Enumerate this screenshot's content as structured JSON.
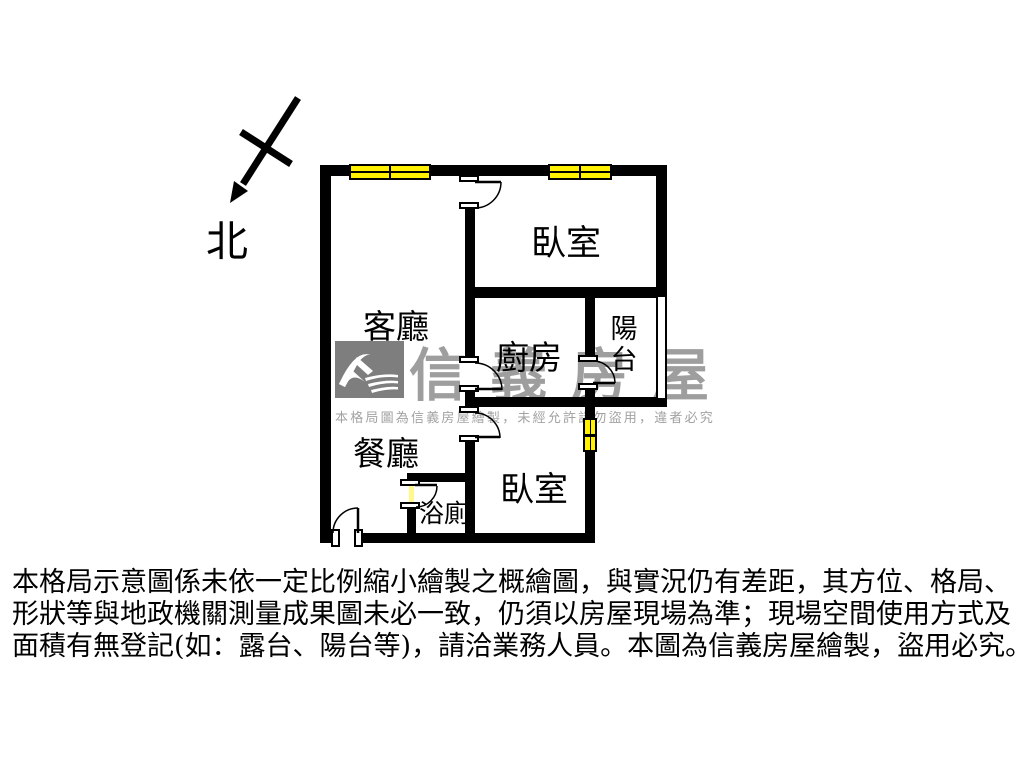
{
  "compass": {
    "label": "北"
  },
  "rooms": {
    "living": {
      "label": "客廳"
    },
    "bedroom_top": {
      "label": "臥室"
    },
    "kitchen": {
      "label": "廚房"
    },
    "balcony": {
      "label": "陽台"
    },
    "dining": {
      "label": "餐廳"
    },
    "bathroom": {
      "label": "浴廁"
    },
    "bedroom_bottom": {
      "label": "臥室"
    }
  },
  "watermark": {
    "brand": "信義房屋",
    "notice": "本格局圖為信義房屋繪製，未經允許請勿盜用，違者必究"
  },
  "disclaimer": {
    "line1": "本格局示意圖係未依一定比例縮小繪製之概繪圖，與實況仍有差距，其方位、格局、",
    "line2": "形狀等與地政機關測量成果圖未必一致，仍須以房屋現場為準；現場空間使用方式及",
    "line3": "面積有無登記(如：露台、陽台等)，請洽業務人員。本圖為信義房屋繪製，盜用必究。"
  },
  "colors": {
    "wall": "#000000",
    "window_yellow": "#fff100",
    "watermark_gray": "#8f8f8f"
  }
}
